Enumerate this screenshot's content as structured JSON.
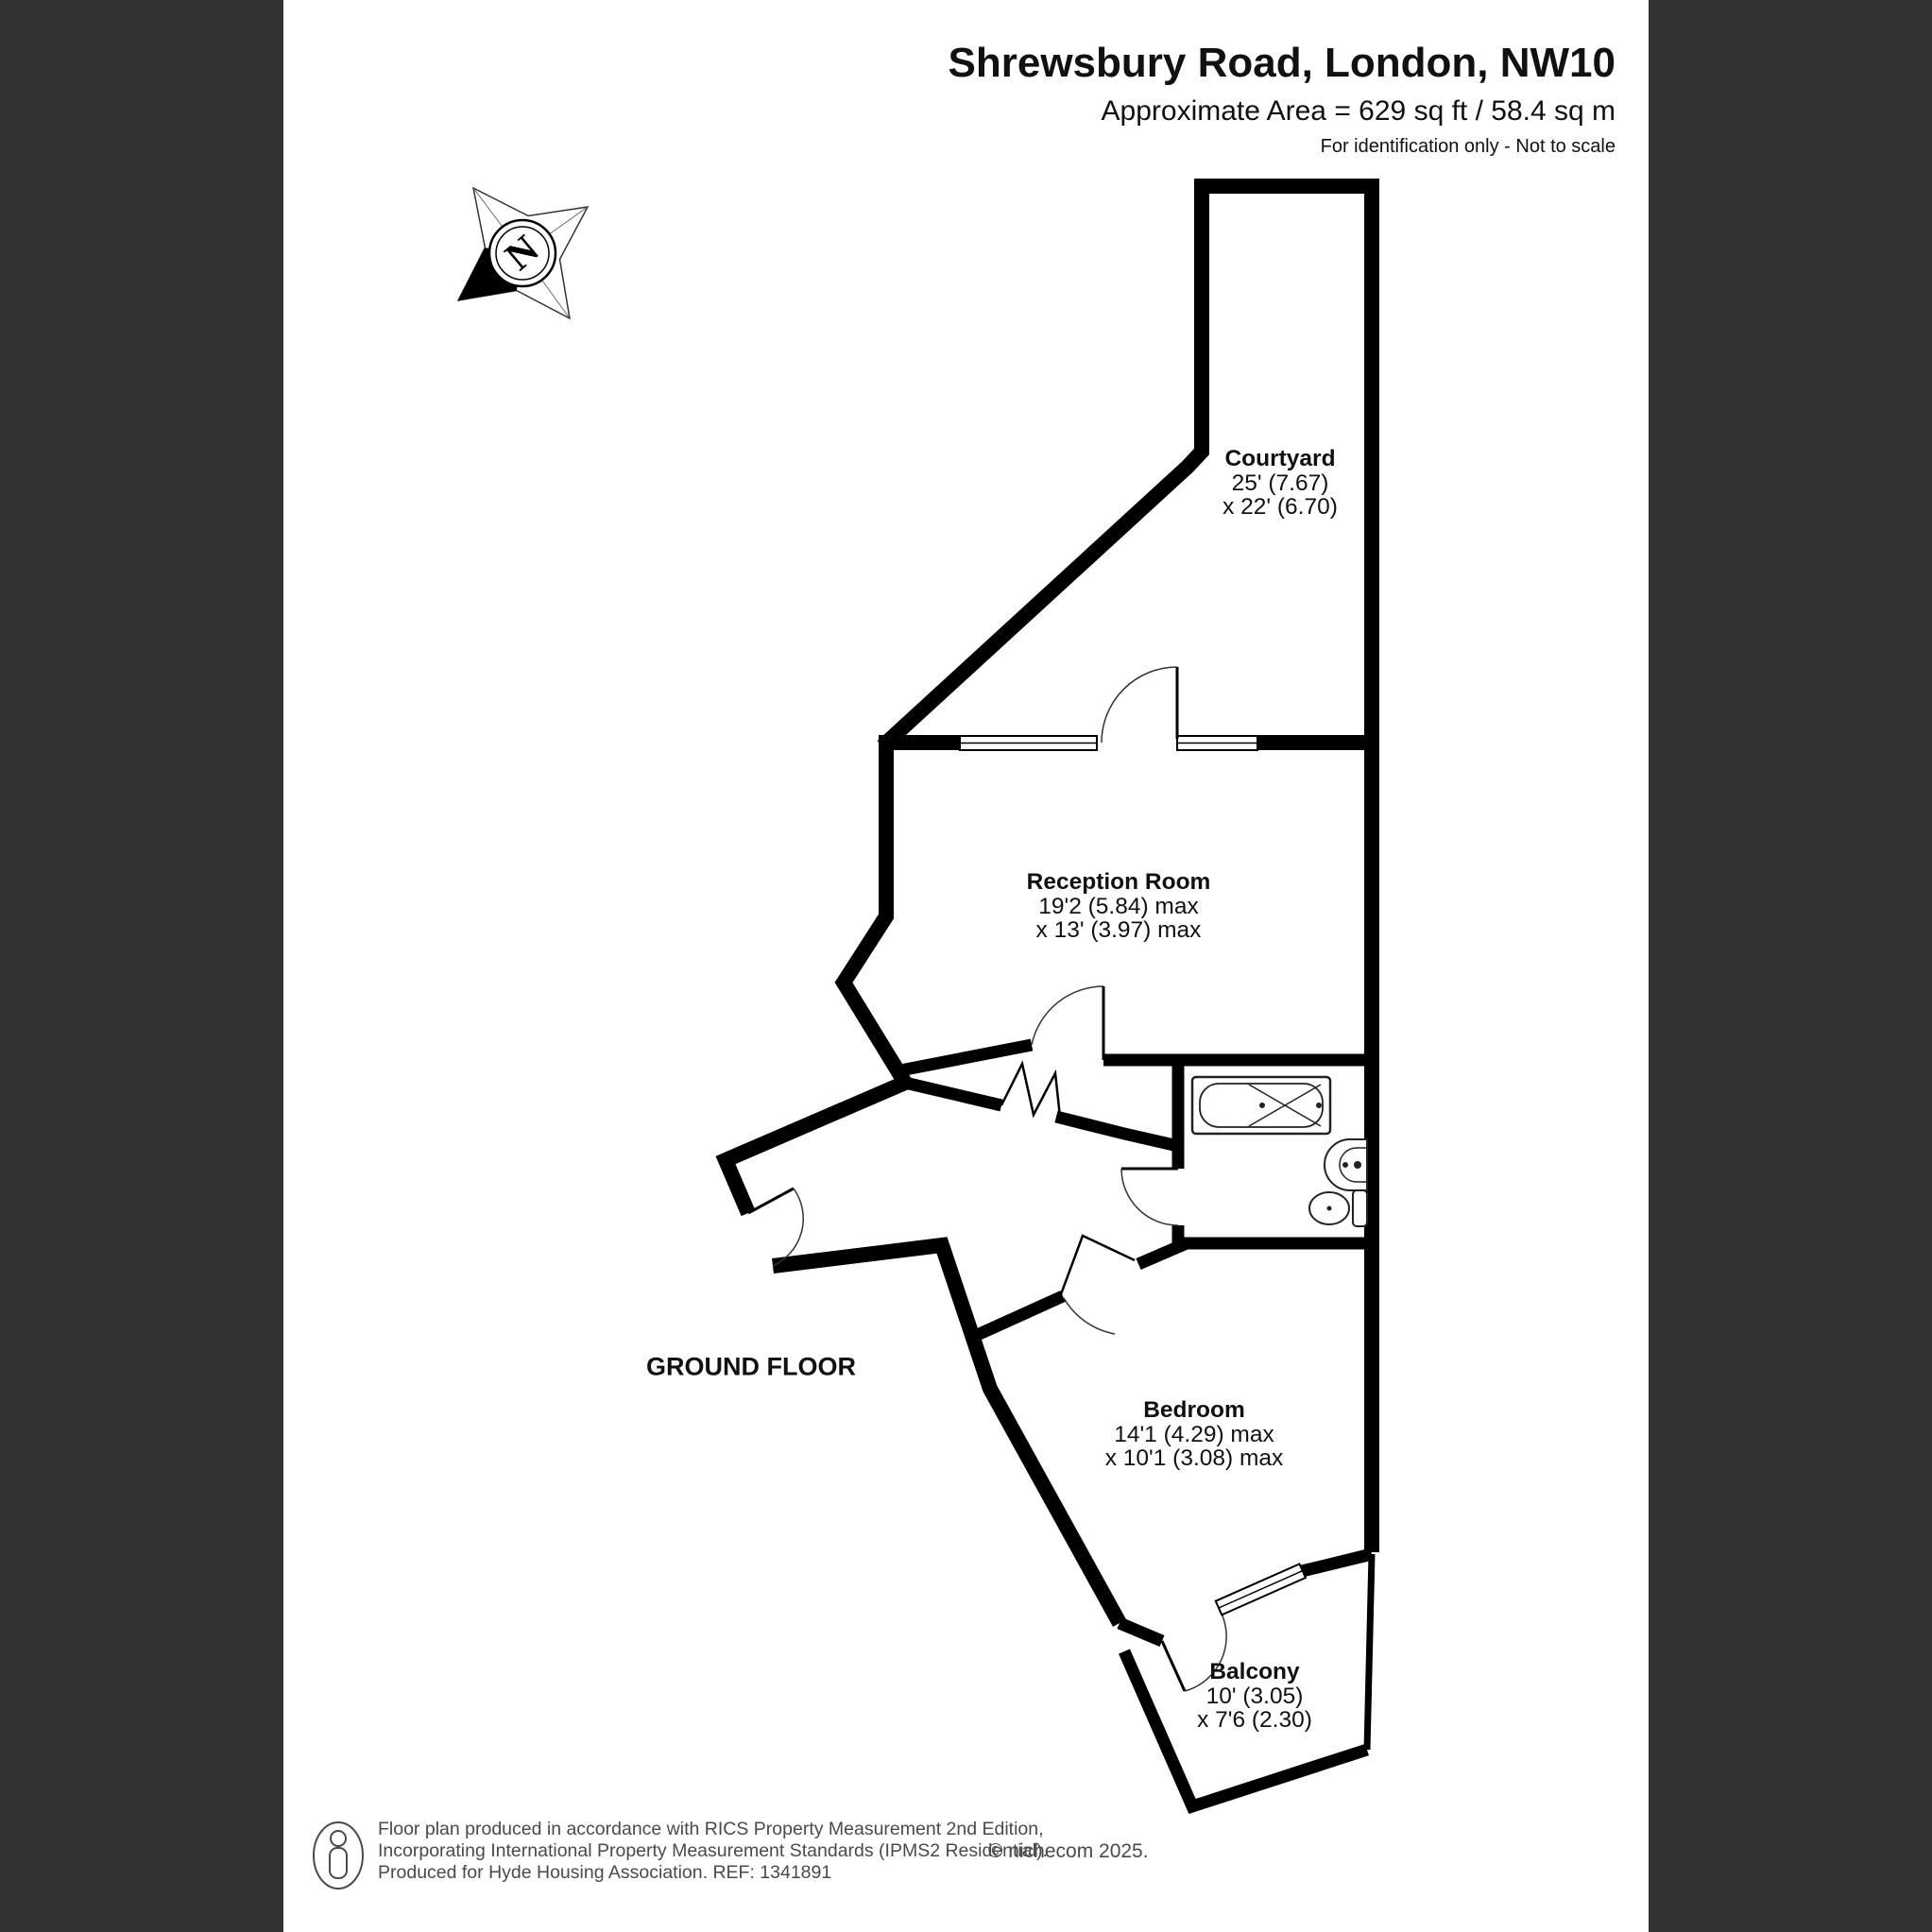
{
  "header": {
    "title": "Shrewsbury Road, London, NW10",
    "area": "Approximate Area = 629 sq ft / 58.4 sq m",
    "disclaimer": "For identification only - Not to scale"
  },
  "plan": {
    "floor_label": "GROUND FLOOR"
  },
  "compass": {
    "north": "N"
  },
  "rooms": {
    "courtyard": {
      "name": "Courtyard",
      "dim1": "25' (7.67)",
      "dim2": "x 22' (6.70)"
    },
    "reception": {
      "name": "Reception Room",
      "dim1": "19'2 (5.84) max",
      "dim2": "x 13' (3.97) max"
    },
    "bedroom": {
      "name": "Bedroom",
      "dim1": "14'1 (4.29) max",
      "dim2": "x 10'1 (3.08) max"
    },
    "balcony": {
      "name": "Balcony",
      "dim1": "10' (3.05)",
      "dim2": "x 7'6 (2.30)"
    }
  },
  "footer": {
    "line1": "Floor plan produced in accordance with RICS Property Measurement 2nd Edition,",
    "line2": "Incorporating International Property Measurement Standards (IPMS2 Residential).",
    "line3": "Produced for Hyde Housing Association.  REF: 1341891",
    "copyright": "© nichecom 2025."
  },
  "colors": {
    "wall": "#000000",
    "sidebar": "#323234",
    "footer_text": "#4a4a4a",
    "fixture_line": "#222222"
  }
}
